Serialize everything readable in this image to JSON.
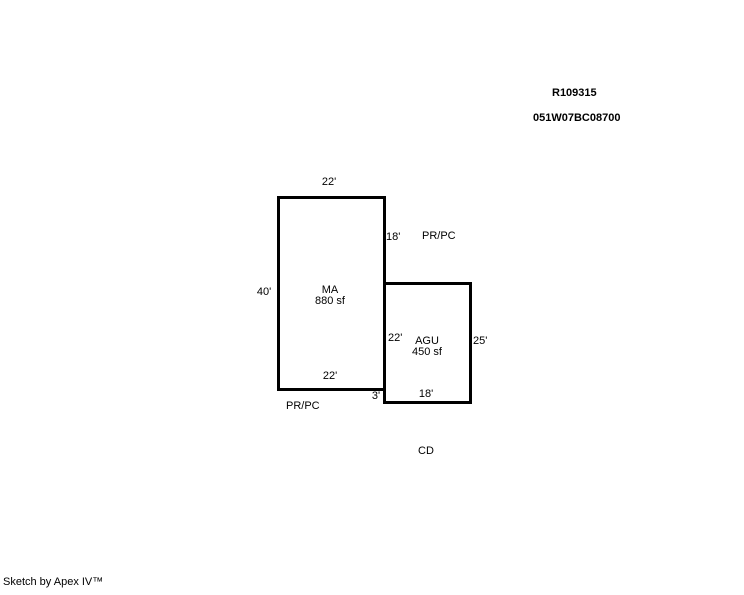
{
  "header": {
    "record_id": "R109315",
    "parcel_id": "051W07BC08700"
  },
  "sketch": {
    "ma": {
      "code": "MA",
      "area": "880 sf",
      "dim_top": "22'",
      "dim_left": "40'",
      "dim_bottom": "22'",
      "dim_right_upper": "18'"
    },
    "agu": {
      "code": "AGU",
      "area": "450 sf",
      "dim_left_upper": "22'",
      "dim_left_lower": "3'",
      "dim_right": "25'",
      "dim_bottom": "18'"
    },
    "annotations": {
      "prpc_upper": "PR/PC",
      "prpc_lower": "PR/PC",
      "cd": "CD"
    }
  },
  "footer": {
    "credit": "Sketch by Apex IV™"
  },
  "colors": {
    "line": "#000000",
    "background": "#ffffff"
  }
}
